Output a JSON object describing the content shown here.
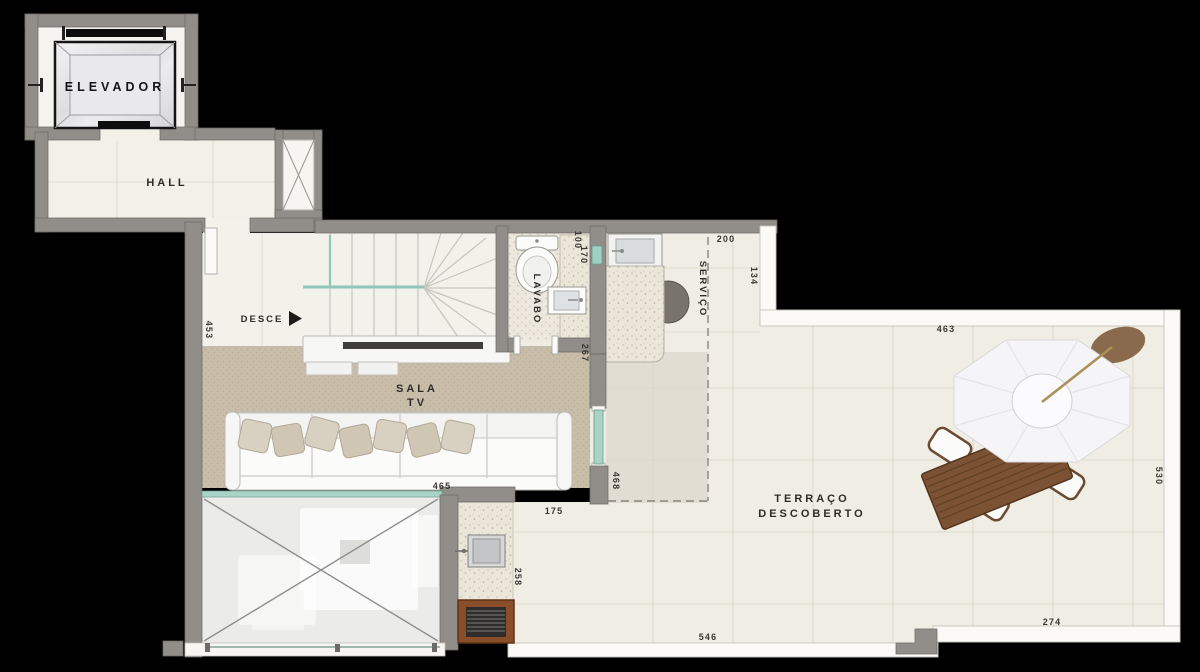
{
  "plan_title": "Penthouse upper-floor plan",
  "labels": {
    "elevador": "ELEVADOR",
    "hall": "HALL",
    "desce": "DESCE",
    "lavabo": "LAVABO",
    "servico": "SERVIÇO",
    "sala_1": "SALA",
    "sala_2": "TV",
    "terraco_1": "TERRAÇO",
    "terraco_2": "DESCOBERTO"
  },
  "dimensions": {
    "stair_hall_height": "453",
    "sala_width": "465",
    "lavabo_door": "100",
    "lavabo_width": "170",
    "lavabo_depth": "267",
    "servico_width": "200",
    "servico_side": "134",
    "terrace_top_width": "463",
    "terrace_right_height": "530",
    "sala_right_side": "468",
    "terrace_strip_width": "175",
    "churrasqueira_height": "258",
    "terrace_bottom_left": "546",
    "terrace_bottom_right": "274"
  },
  "icons": {
    "desce_arrow": "right-triangle"
  },
  "colors": {
    "background": "#000000",
    "floor_cream": "#f0eee4",
    "wall_gray": "#918d89",
    "carpet_beige": "#c9beaa",
    "glass_teal": "#a9d3c6",
    "wood_brown": "#7b5334",
    "grill_brown": "#8a4f2a",
    "umbrella_white": "#f5f5f7",
    "plant_brown": "#8a6a4c"
  }
}
